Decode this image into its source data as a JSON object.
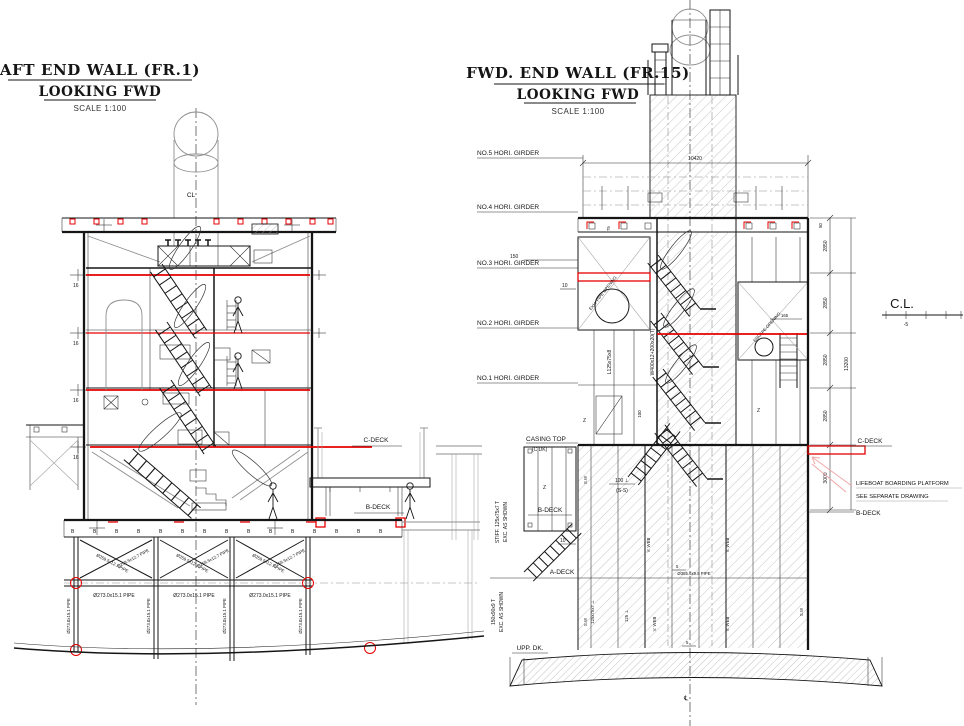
{
  "colors": {
    "line_ink": "#151515",
    "highlight_red": "#e60000",
    "leader_pink": "#f0a8a8",
    "hatch_gray": "#b9b9b9",
    "centerline_gray": "#555555"
  },
  "left_drawing": {
    "title": "AFT END WALL (FR.1)",
    "subtitle": "LOOKING FWD",
    "scale": "SCALE 1:100",
    "centerline": "CL",
    "c_deck": "C-DECK",
    "b_deck": "B-DECK",
    "thickness": "16",
    "beam_mark": "B",
    "pipe_diag": "Ø259.5x12.7 PIPE",
    "pipe_horiz": "Ø273.0x15.1 PIPE",
    "pipe_vert": "Ø273.0x15.1 PIPE"
  },
  "right_drawing": {
    "title": "FWD. END WALL (FR.15)",
    "subtitle": "LOOKING FWD",
    "scale": "SCALE 1:100",
    "girders": [
      "NO.5 HORI. GIRDER",
      "NO.4 HORI. GIRDER",
      "NO.3 HORI. GIRDER",
      "NO.2 HORI. GIRDER",
      "NO.1 HORI. GIRDER"
    ],
    "casing_top": "CASING TOP",
    "casing_top_sub": "(C DK)",
    "b_deck_left": "B-DECK",
    "a_deck": "A-DECK",
    "upp_dk": "UPP. DK.",
    "stiff_note1_l1": "STIFF. 125x75x7 T",
    "stiff_note1_l2": "EXC. AS SHOWN",
    "stiff_note2_l1": "150x90x9 T",
    "stiff_note2_l2": "EXC. AS SHOWN",
    "c_deck_right": "C-DECK",
    "b_deck_right": "B-DECK",
    "lifeboat_l1": "LIFEBOAT BOARDING PLATFORM",
    "lifeboat_l2": "SEE SEPARATE DRAWING",
    "cl": "C.L.",
    "cl_tick": "-5",
    "dim_top_width": "10420",
    "dim_tier": "2850",
    "dim_total": "13200",
    "dim_bdeck": "3000",
    "dim_150": "150",
    "dim_75": "75",
    "dim_100": "100",
    "dim_10": "10",
    "dim_165": "165",
    "dim_50": "50",
    "note_100ss_l1": "100 ⊥",
    "note_100ss_l2": "(S-S)",
    "web_frame": "W400x12+200x20(T)",
    "angle": "L125x75x8",
    "stiff_a": "125x75x7 ⊥",
    "stiff_b": "125 ⊥",
    "v_web": "V. WEB",
    "s_w": "S.W",
    "z_mark": "Z",
    "beam_mark": "B",
    "opening_left": "EXH. PIPE OPENING",
    "opening_right": "ESCAPE OPENING",
    "pipe_note": "Ø355.6x9.5 PIPE",
    "weld_5": "5",
    "cl_symbol": "℄"
  }
}
